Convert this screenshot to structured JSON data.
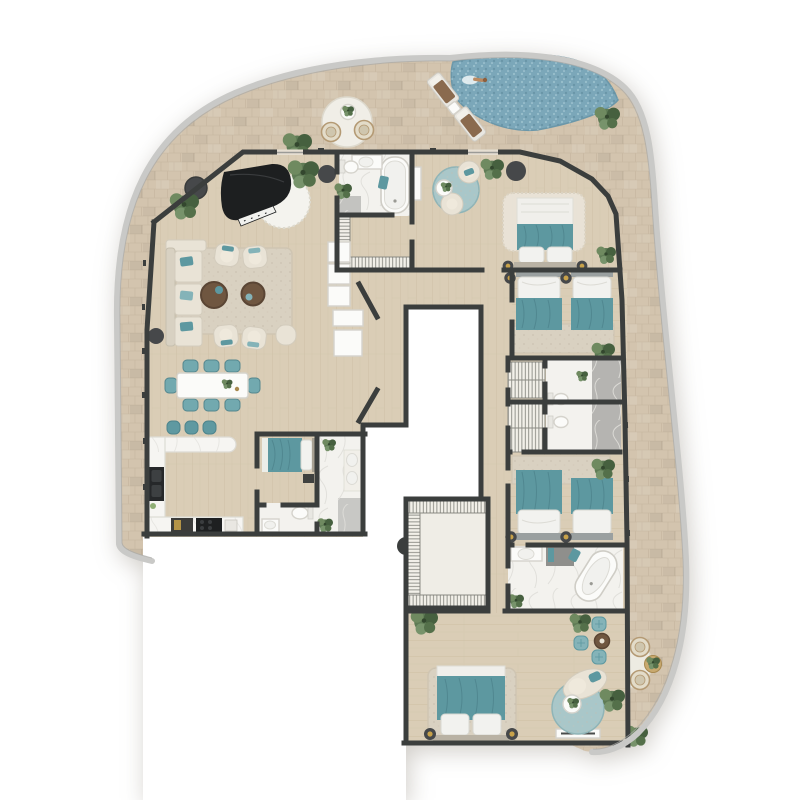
{
  "meta": {
    "type": "apartment-floor-plan",
    "view": "top-down-render",
    "background": "#ffffff"
  },
  "colors": {
    "wall": "#3b3e3d",
    "tile": "#d3c4ae",
    "tile_line": "#c2b199",
    "wood": "#dacdb6",
    "wood_line": "#c9bb9f",
    "marble": "#f3f2ee",
    "marble_gray": "#b5b4b1",
    "pool": "#7ba7b9",
    "pool_deep": "#628fa2",
    "pool_light": "#a9cad4",
    "rail": "#c9c9c7",
    "teal": "#5d98a0",
    "teal_light": "#84b3b8",
    "cream": "#e9e3d6",
    "rug": "#d9d1c1",
    "rug_white": "#f4f3ee",
    "wicker": "#e3dcc9",
    "wood_brown": "#6f5640",
    "towel_brown": "#8a6a4e",
    "plant": "#5f7b55",
    "plant_dark": "#46603f",
    "piano_black": "#1d1f20",
    "dark_fixture": "#46484a",
    "lamp_gold": "#c8a24a",
    "void": "#ffffff"
  },
  "legend": {
    "rooms": [
      "wraparound-terrace",
      "pool",
      "living-room",
      "dining-area",
      "kitchen",
      "entry-hall",
      "master-bedroom",
      "master-bathroom",
      "dressing-corridor",
      "staff-bedroom",
      "staff-bathroom",
      "guest-powder-rooms",
      "hallway",
      "twin-bedroom-north",
      "twin-bedroom-south",
      "guest-bathroom-north",
      "guest-bathroom-south",
      "second-master-bathroom",
      "walk-in-wardrobe",
      "second-master-bedroom",
      "elevator-core-void"
    ],
    "furniture_fixtures": [
      "grand-piano",
      "round-shag-rug",
      "sectional-sofa",
      "armchairs",
      "round-coffee-tables",
      "dining-table-with-8-chairs",
      "kitchen-counter-island",
      "bar-stools",
      "cooktop",
      "kitchen-sink",
      "double-beds",
      "twin-beds",
      "bedside-lamps",
      "freestanding-bathtub",
      "built-in-bathtub",
      "toilets",
      "sinks",
      "showers",
      "wardrobe-racks",
      "chaise-lounge",
      "poufs",
      "tv-console",
      "entry-cabinets",
      "indoor-plants",
      "side-tables"
    ],
    "outdoor": [
      "pool-with-swimmer",
      "sun-loungers",
      "lounger-side-table",
      "terrace-seating-set-north",
      "terrace-seating-set-east",
      "terrace-plants",
      "glass-railing"
    ]
  }
}
